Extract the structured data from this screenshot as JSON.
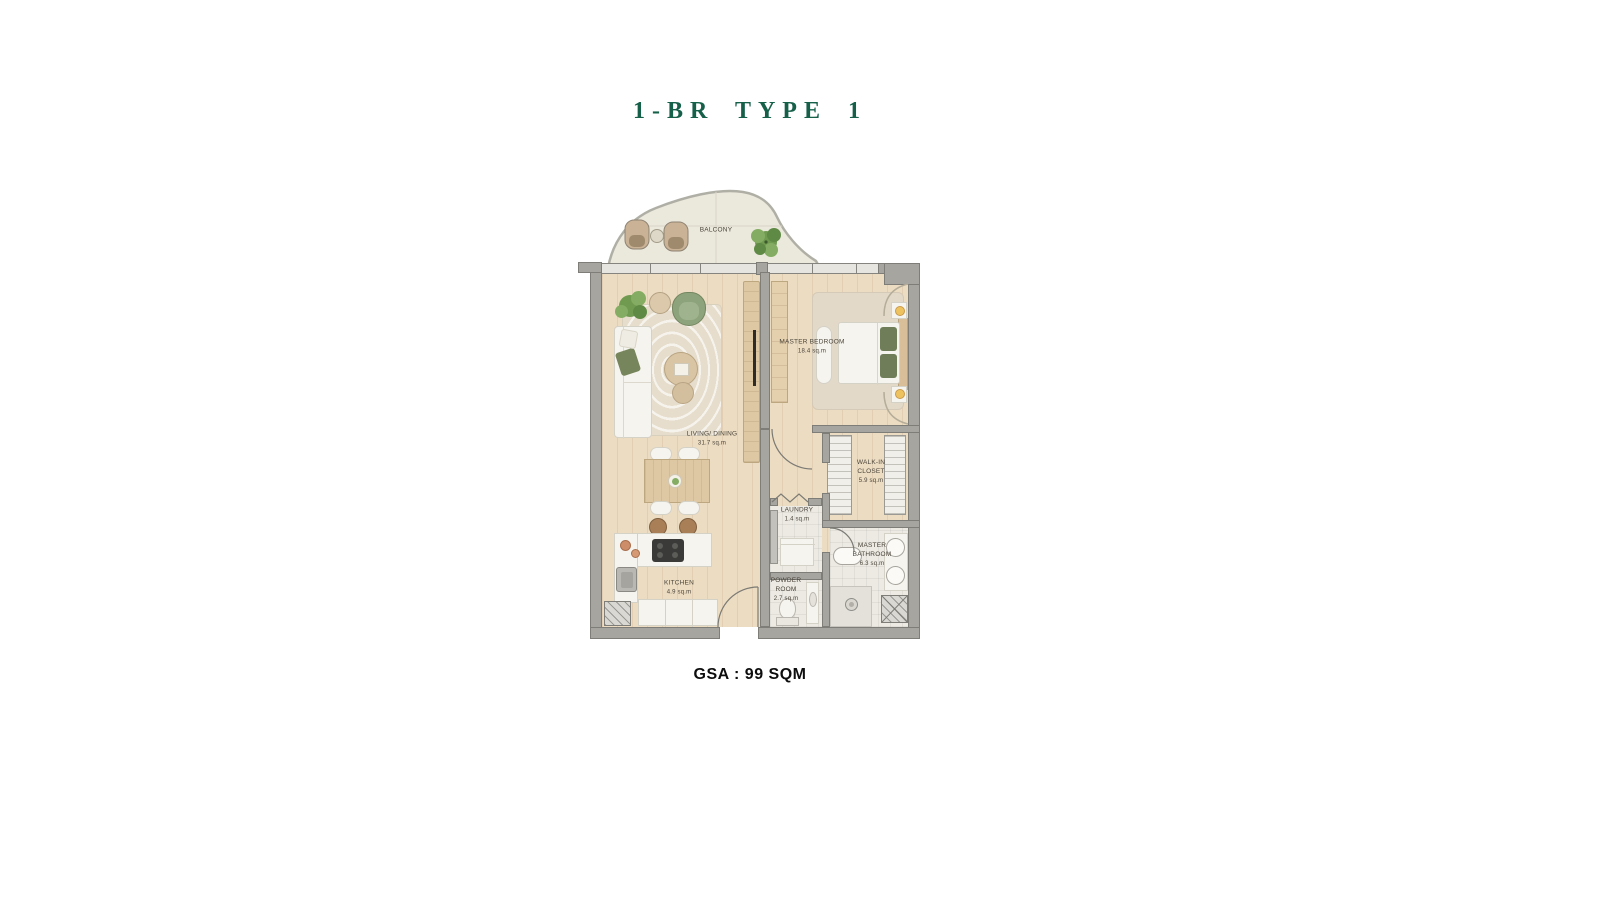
{
  "header": {
    "title": "1-BR TYPE 1"
  },
  "footer": {
    "gsa_label": "GSA : 99 SQM"
  },
  "palette": {
    "accent_green": "#16604a",
    "wall_gray": "#a6a5a0",
    "wood_floor": "#ecdcc2",
    "tile_floor": "#eceae3",
    "label_text": "#4a443a",
    "greenery": "#7aa05a",
    "gsa_text": "#0d0d0d"
  },
  "floorplan": {
    "balcony": {
      "label": "BALCONY"
    },
    "rooms": {
      "living_dining": {
        "label": "LIVING/ DINING",
        "area": "31.7 sq.m"
      },
      "master_bedroom": {
        "label": "MASTER BEDROOM",
        "area": "18.4 sq.m"
      },
      "walk_in_closet": {
        "label": "WALK-IN CLOSET",
        "area": "5.9 sq.m"
      },
      "laundry": {
        "label": "LAUNDRY",
        "area": "1.4 sq.m"
      },
      "powder_room": {
        "label": "POWDER ROOM",
        "area": "2.7 sq.m"
      },
      "master_bathroom": {
        "label": "MASTER BATHROOM",
        "area": "6.3 sq.m"
      },
      "kitchen": {
        "label": "KITCHEN",
        "area": "4.9 sq.m"
      }
    }
  }
}
